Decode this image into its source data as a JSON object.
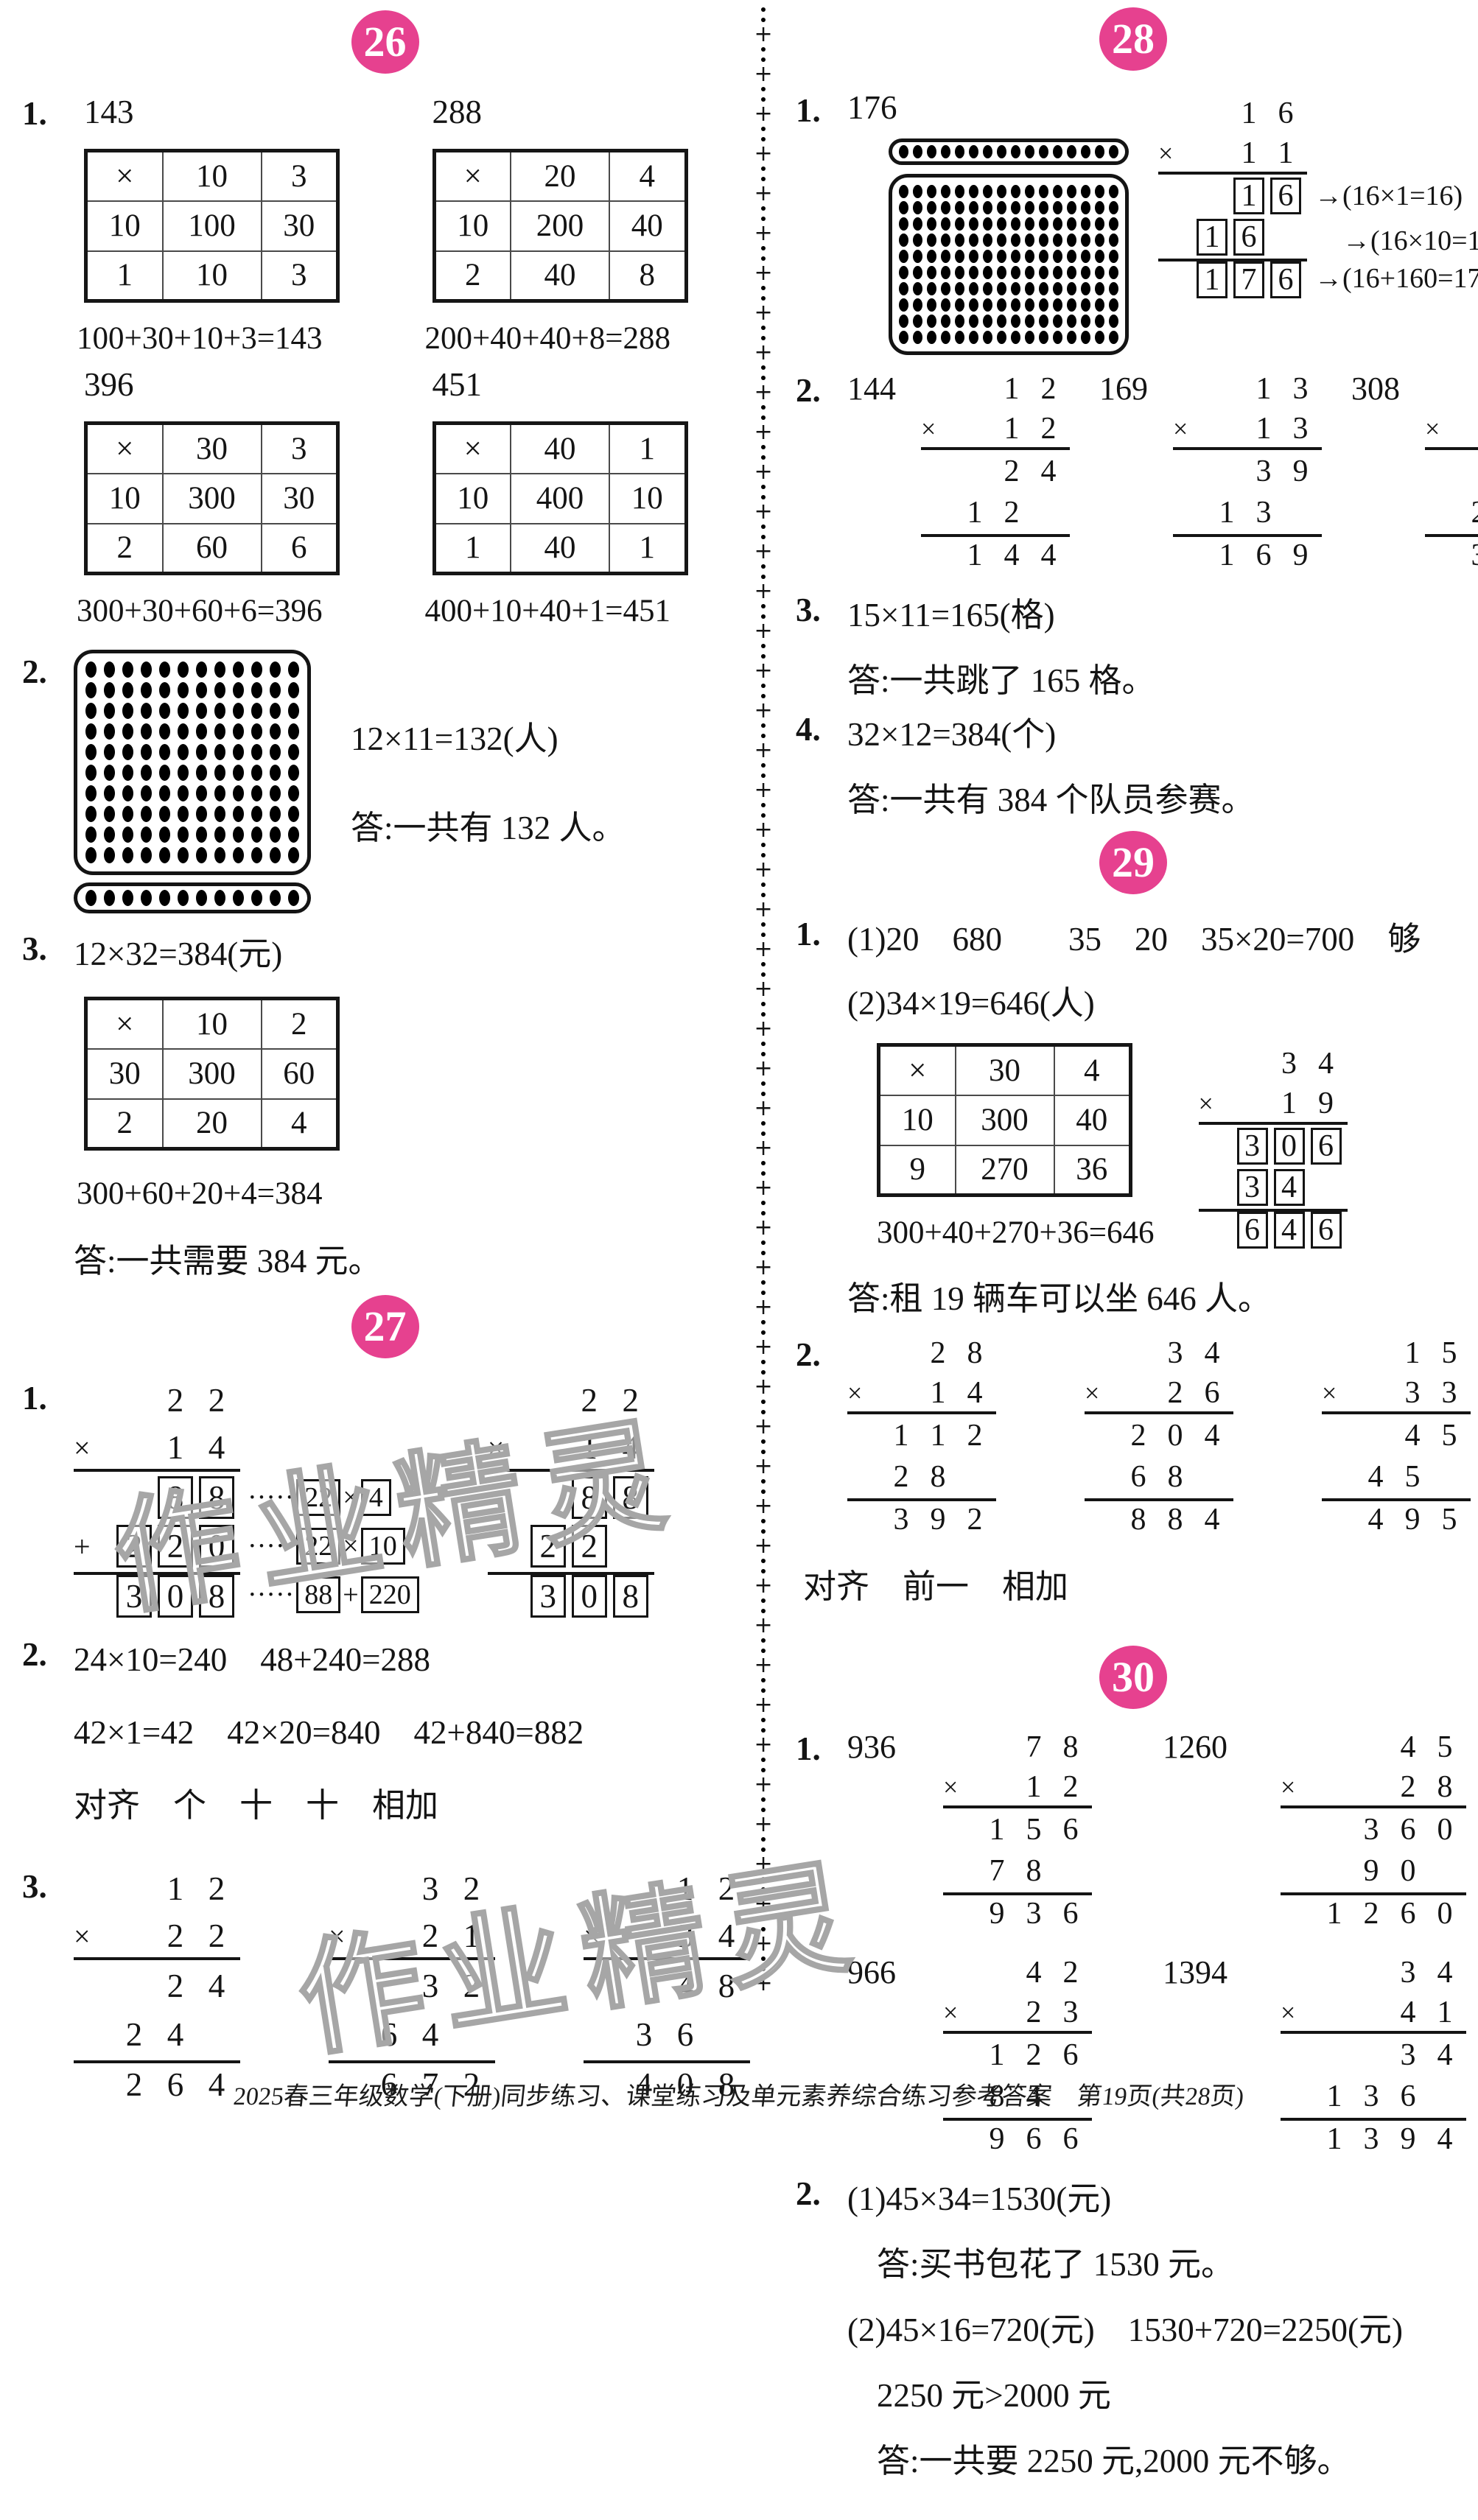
{
  "page": {
    "badge_color": "#e6418f",
    "watermark": "作业精灵",
    "footer": "2025春三年级数学(下册)同步练习、课堂练习及单元素养综合练习参考答案　第19页(共28页)"
  },
  "s26": {
    "badge": "26",
    "i1": {
      "no": "1.",
      "blocks": [
        {
          "num": "143",
          "table": [
            [
              "×",
              "10",
              "3"
            ],
            [
              "10",
              "100",
              "30"
            ],
            [
              "1",
              "10",
              "3"
            ]
          ],
          "eq": "100+30+10+3=143"
        },
        {
          "num": "288",
          "table": [
            [
              "×",
              "20",
              "4"
            ],
            [
              "10",
              "200",
              "40"
            ],
            [
              "2",
              "40",
              "8"
            ]
          ],
          "eq": "200+40+40+8=288"
        },
        {
          "num": "396",
          "table": [
            [
              "×",
              "30",
              "3"
            ],
            [
              "10",
              "300",
              "30"
            ],
            [
              "2",
              "60",
              "6"
            ]
          ],
          "eq": "300+30+60+6=396"
        },
        {
          "num": "451",
          "table": [
            [
              "×",
              "40",
              "1"
            ],
            [
              "10",
              "400",
              "10"
            ],
            [
              "1",
              "40",
              "1"
            ]
          ],
          "eq": "400+10+40+1=451"
        }
      ]
    },
    "i2": {
      "no": "2.",
      "dots": {
        "cols": 12,
        "main_rows": 10,
        "strip_rows": 1,
        "strip_pos": "bottom",
        "size": "lg"
      },
      "expr": "12×11=132(人)",
      "ans": "答:一共有 132 人。"
    },
    "i3": {
      "no": "3.",
      "expr": "12×32=384(元)",
      "table": [
        [
          "×",
          "10",
          "2"
        ],
        [
          "30",
          "300",
          "60"
        ],
        [
          "2",
          "20",
          "4"
        ]
      ],
      "eq": "300+60+20+4=384",
      "ans": "答:一共需要 384 元。"
    }
  },
  "s27": {
    "badge": "27",
    "i1": {
      "no": "1.",
      "left": {
        "rows": [
          {
            "cells": [
              "",
              "2",
              "2"
            ]
          },
          {
            "sign": "×",
            "cells": [
              "",
              "1",
              "4"
            ],
            "rule": "below"
          },
          {
            "cells": [
              "",
              "8",
              "8"
            ],
            "boxed": true,
            "note": [
              {
                "t": "·····"
              },
              {
                "t": "22",
                "box": true
              },
              {
                "t": "×"
              },
              {
                "t": "4",
                "box": true
              }
            ]
          },
          {
            "sign": "+",
            "cells": [
              "2",
              "2",
              "0"
            ],
            "boxed": true,
            "note": [
              {
                "t": "·····"
              },
              {
                "t": "22",
                "box": true
              },
              {
                "t": "×"
              },
              {
                "t": "10",
                "box": true
              }
            ]
          },
          {
            "cells": [
              "3",
              "0",
              "8"
            ],
            "boxed": true,
            "rule": "above",
            "note": [
              {
                "t": "·····"
              },
              {
                "t": "88",
                "box": true
              },
              {
                "t": "+"
              },
              {
                "t": "220",
                "box": true
              }
            ]
          }
        ]
      },
      "right": {
        "rows": [
          {
            "cells": [
              "",
              "2",
              "2"
            ]
          },
          {
            "sign": "×",
            "cells": [
              "",
              "1",
              "4"
            ],
            "rule": "below"
          },
          {
            "cells": [
              "",
              "8",
              "8"
            ],
            "boxed": true
          },
          {
            "cells": [
              "2",
              "2",
              ""
            ],
            "boxed": true
          },
          {
            "cells": [
              "3",
              "0",
              "8"
            ],
            "boxed": true,
            "rule": "above"
          }
        ]
      }
    },
    "i2": {
      "no": "2.",
      "l1": "24×10=240　48+240=288",
      "l2": "42×1=42　42×20=840　42+840=882",
      "l3": "对齐　个　十　十　相加"
    },
    "i3": {
      "no": "3.",
      "a": {
        "rows": [
          {
            "cells": [
              "",
              "1",
              "2"
            ]
          },
          {
            "sign": "×",
            "cells": [
              "",
              "2",
              "2"
            ],
            "rule": "below"
          },
          {
            "cells": [
              "",
              "2",
              "4"
            ]
          },
          {
            "cells": [
              "2",
              "4",
              ""
            ]
          },
          {
            "cells": [
              "2",
              "6",
              "4"
            ],
            "rule": "above"
          }
        ]
      },
      "b": {
        "rows": [
          {
            "cells": [
              "",
              "3",
              "2"
            ]
          },
          {
            "sign": "×",
            "cells": [
              "",
              "2",
              "1"
            ],
            "rule": "below"
          },
          {
            "cells": [
              "",
              "3",
              "2"
            ]
          },
          {
            "cells": [
              "6",
              "4",
              ""
            ]
          },
          {
            "cells": [
              "6",
              "7",
              "2"
            ],
            "rule": "above"
          }
        ]
      },
      "c": {
        "rows": [
          {
            "cells": [
              "",
              "1",
              "2"
            ]
          },
          {
            "sign": "×",
            "cells": [
              "",
              "3",
              "4"
            ],
            "rule": "below"
          },
          {
            "cells": [
              "",
              "4",
              "8"
            ]
          },
          {
            "cells": [
              "3",
              "6",
              ""
            ]
          },
          {
            "cells": [
              "4",
              "0",
              "8"
            ],
            "rule": "above"
          }
        ]
      }
    }
  },
  "s28": {
    "badge": "28",
    "i1": {
      "no": "1.",
      "label": "176",
      "dots": {
        "cols": 16,
        "main_rows": 10,
        "strip_rows": 1,
        "strip_pos": "top",
        "size": "sm"
      },
      "vm": {
        "rows": [
          {
            "cells": [
              "",
              "1",
              "6"
            ]
          },
          {
            "sign": "×",
            "cells": [
              "",
              "1",
              "1"
            ],
            "rule": "below"
          },
          {
            "cells": [
              "",
              "1",
              "6"
            ],
            "boxed": true,
            "note": [
              {
                "t": "→(16×1=16)"
              }
            ]
          },
          {
            "cells": [
              "1",
              "6",
              ""
            ],
            "boxed": true,
            "note": [
              {
                "t": "　→(16×10=160)"
              }
            ]
          },
          {
            "cells": [
              "1",
              "7",
              "6"
            ],
            "boxed": true,
            "rule": "above",
            "note": [
              {
                "t": "→(16+160=176)"
              }
            ]
          }
        ]
      }
    },
    "i2": {
      "no": "2.",
      "g1": {
        "label": "144",
        "vm": {
          "rows": [
            {
              "cells": [
                "",
                "1",
                "2"
              ]
            },
            {
              "sign": "×",
              "cells": [
                "",
                "1",
                "2"
              ],
              "rule": "below"
            },
            {
              "cells": [
                "",
                "2",
                "4"
              ]
            },
            {
              "cells": [
                "1",
                "2",
                ""
              ]
            },
            {
              "cells": [
                "1",
                "4",
                "4"
              ],
              "rule": "above"
            }
          ]
        }
      },
      "g2": {
        "label": "169",
        "vm": {
          "rows": [
            {
              "cells": [
                "",
                "1",
                "3"
              ]
            },
            {
              "sign": "×",
              "cells": [
                "",
                "1",
                "3"
              ],
              "rule": "below"
            },
            {
              "cells": [
                "",
                "3",
                "9"
              ]
            },
            {
              "cells": [
                "1",
                "3",
                ""
              ]
            },
            {
              "cells": [
                "1",
                "6",
                "9"
              ],
              "rule": "above"
            }
          ]
        }
      },
      "g3": {
        "label": "308",
        "vm": {
          "rows": [
            {
              "cells": [
                "",
                "1",
                "4"
              ]
            },
            {
              "sign": "×",
              "cells": [
                "",
                "2",
                "2"
              ],
              "rule": "below"
            },
            {
              "cells": [
                "",
                "2",
                "8"
              ]
            },
            {
              "cells": [
                "2",
                "8",
                ""
              ]
            },
            {
              "cells": [
                "3",
                "0",
                "8"
              ],
              "rule": "above"
            }
          ]
        }
      }
    },
    "i3": {
      "no": "3.",
      "expr": "15×11=165(格)",
      "ans": "答:一共跳了 165 格。"
    },
    "i4": {
      "no": "4.",
      "expr": "32×12=384(个)",
      "ans": "答:一共有 384 个队员参赛。"
    }
  },
  "s29": {
    "badge": "29",
    "i1": {
      "no": "1.",
      "l1": "(1)20　680　　35　20　35×20=700　够",
      "l2": "(2)34×19=646(人)",
      "table": [
        [
          "×",
          "30",
          "4"
        ],
        [
          "10",
          "300",
          "40"
        ],
        [
          "9",
          "270",
          "36"
        ]
      ],
      "eq": "300+40+270+36=646",
      "vm": {
        "rows": [
          {
            "cells": [
              "",
              "3",
              "4"
            ]
          },
          {
            "sign": "×",
            "cells": [
              "",
              "1",
              "9"
            ],
            "rule": "below"
          },
          {
            "cells": [
              "3",
              "0",
              "6"
            ],
            "boxed": true
          },
          {
            "cells": [
              "3",
              "4",
              ""
            ],
            "boxed": true
          },
          {
            "cells": [
              "6",
              "4",
              "6"
            ],
            "boxed": true,
            "rule": "above"
          }
        ]
      },
      "ans": "答:租 19 辆车可以坐 646 人。"
    },
    "i2": {
      "no": "2.",
      "a": {
        "rows": [
          {
            "cells": [
              "",
              "2",
              "8"
            ]
          },
          {
            "sign": "×",
            "cells": [
              "",
              "1",
              "4"
            ],
            "rule": "below"
          },
          {
            "cells": [
              "1",
              "1",
              "2"
            ]
          },
          {
            "cells": [
              "2",
              "8",
              ""
            ]
          },
          {
            "cells": [
              "3",
              "9",
              "2"
            ],
            "rule": "above"
          }
        ]
      },
      "b": {
        "rows": [
          {
            "cells": [
              "",
              "3",
              "4"
            ]
          },
          {
            "sign": "×",
            "cells": [
              "",
              "2",
              "6"
            ],
            "rule": "below"
          },
          {
            "cells": [
              "2",
              "0",
              "4"
            ]
          },
          {
            "cells": [
              "6",
              "8",
              ""
            ]
          },
          {
            "cells": [
              "8",
              "8",
              "4"
            ],
            "rule": "above"
          }
        ]
      },
      "c": {
        "rows": [
          {
            "cells": [
              "",
              "1",
              "5"
            ]
          },
          {
            "sign": "×",
            "cells": [
              "",
              "3",
              "3"
            ],
            "rule": "below"
          },
          {
            "cells": [
              "",
              "4",
              "5"
            ]
          },
          {
            "cells": [
              "4",
              "5",
              ""
            ]
          },
          {
            "cells": [
              "4",
              "9",
              "5"
            ],
            "rule": "above"
          }
        ]
      },
      "l1": "对齐　前一　相加"
    }
  },
  "s30": {
    "badge": "30",
    "i1": {
      "no": "1.",
      "g1": {
        "label": "936",
        "vm": {
          "rows": [
            {
              "cells": [
                "",
                "7",
                "8"
              ]
            },
            {
              "sign": "×",
              "cells": [
                "",
                "1",
                "2"
              ],
              "rule": "below"
            },
            {
              "cells": [
                "1",
                "5",
                "6"
              ]
            },
            {
              "cells": [
                "7",
                "8",
                ""
              ]
            },
            {
              "cells": [
                "9",
                "3",
                "6"
              ],
              "rule": "above"
            }
          ]
        }
      },
      "g2": {
        "label": "1260",
        "vm": {
          "rows": [
            {
              "cells": [
                "",
                "",
                "4",
                "5"
              ]
            },
            {
              "sign": "×",
              "cells": [
                "",
                "",
                "2",
                "8"
              ],
              "rule": "below"
            },
            {
              "cells": [
                "",
                "3",
                "6",
                "0"
              ]
            },
            {
              "cells": [
                "",
                "9",
                "0",
                ""
              ]
            },
            {
              "cells": [
                "1",
                "2",
                "6",
                "0"
              ],
              "rule": "above"
            }
          ]
        }
      },
      "g3": {
        "label": "966",
        "vm": {
          "rows": [
            {
              "cells": [
                "",
                "4",
                "2"
              ]
            },
            {
              "sign": "×",
              "cells": [
                "",
                "2",
                "3"
              ],
              "rule": "below"
            },
            {
              "cells": [
                "1",
                "2",
                "6"
              ]
            },
            {
              "cells": [
                "8",
                "4",
                ""
              ]
            },
            {
              "cells": [
                "9",
                "6",
                "6"
              ],
              "rule": "above"
            }
          ]
        }
      },
      "g4": {
        "label": "1394",
        "vm": {
          "rows": [
            {
              "cells": [
                "",
                "",
                "3",
                "4"
              ]
            },
            {
              "sign": "×",
              "cells": [
                "",
                "",
                "4",
                "1"
              ],
              "rule": "below"
            },
            {
              "cells": [
                "",
                "",
                "3",
                "4"
              ]
            },
            {
              "cells": [
                "1",
                "3",
                "6",
                ""
              ]
            },
            {
              "cells": [
                "1",
                "3",
                "9",
                "4"
              ],
              "rule": "above"
            }
          ]
        }
      }
    },
    "i2": {
      "no": "2.",
      "l1": "(1)45×34=1530(元)",
      "l2": "答:买书包花了 1530 元。",
      "l3": "(2)45×16=720(元)　1530+720=2250(元)",
      "l4": "2250 元>2000 元",
      "l5": "答:一共要 2250 元,2000 元不够。"
    }
  }
}
